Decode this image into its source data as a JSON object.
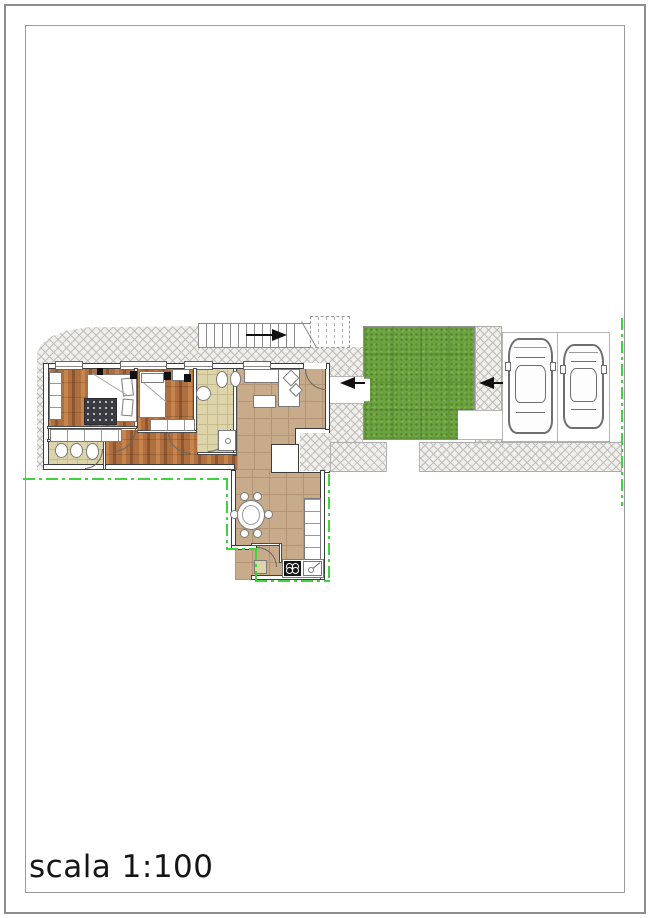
{
  "title": {
    "scale_label": "scala 1:100"
  },
  "colors": {
    "hatch_bg": "#f0efec",
    "hatch_line": "#bdbdb9",
    "wood": "#b06f3e",
    "wood_light": "#c6854d",
    "wood_dark": "#8e5630",
    "tile_beige": "#ded4a9",
    "tile_beige_line": "#c6bb8e",
    "tile_tan": "#c8ab8b",
    "tile_tan_line": "#b39575",
    "grass": "#6ba33e",
    "wall": "#3c3c3c",
    "boundary": "#3ed43e",
    "arrow": "#111111",
    "rug": "#3a3a41"
  },
  "plan": {
    "drawing_type": "apartment-site-floor-plan",
    "rooms": [
      "master-bedroom",
      "second-bedroom",
      "main-bathroom",
      "small-bathroom",
      "hallway",
      "living-room",
      "kitchen-dining",
      "pantry",
      "garden-lawn",
      "parking-stalls",
      "external-staircase",
      "paved-walkway"
    ],
    "counts": {
      "cars": 2,
      "dining_chairs": 6,
      "stove_burners": 4,
      "parking_stalls": 2,
      "entrance_arrows": 3
    }
  }
}
